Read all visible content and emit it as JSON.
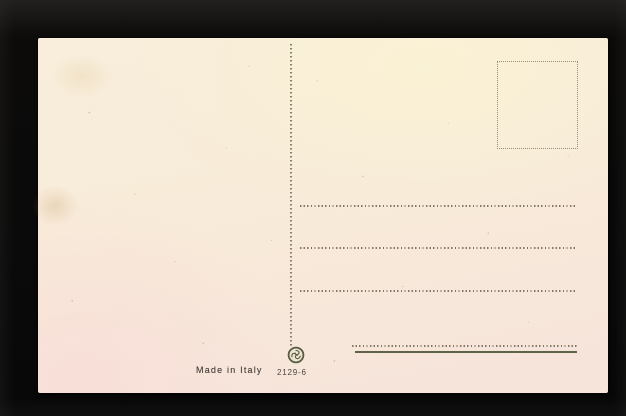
{
  "postcard": {
    "bottom_labels": {
      "made_in": "Made in Italy",
      "serial_number": "2129-6"
    },
    "structure": {
      "divider_style": "dotted-vertical",
      "stamp_box_border": "dotted",
      "address_dotted_line_count": 3,
      "signature_dotted_line": true,
      "signature_solid_underline": true
    },
    "icons": {
      "publisher_logo": "publisher-monogram-icon"
    },
    "colors": {
      "photo_background": "#0a0a0a",
      "card_paper_top": "#f8eedb",
      "card_paper_bottom": "#f6e3da",
      "dotted_rule": "#7a6c5a",
      "solid_rule": "#5f6449",
      "ink_text": "#45413a",
      "logo_ink": "#565b41"
    }
  }
}
